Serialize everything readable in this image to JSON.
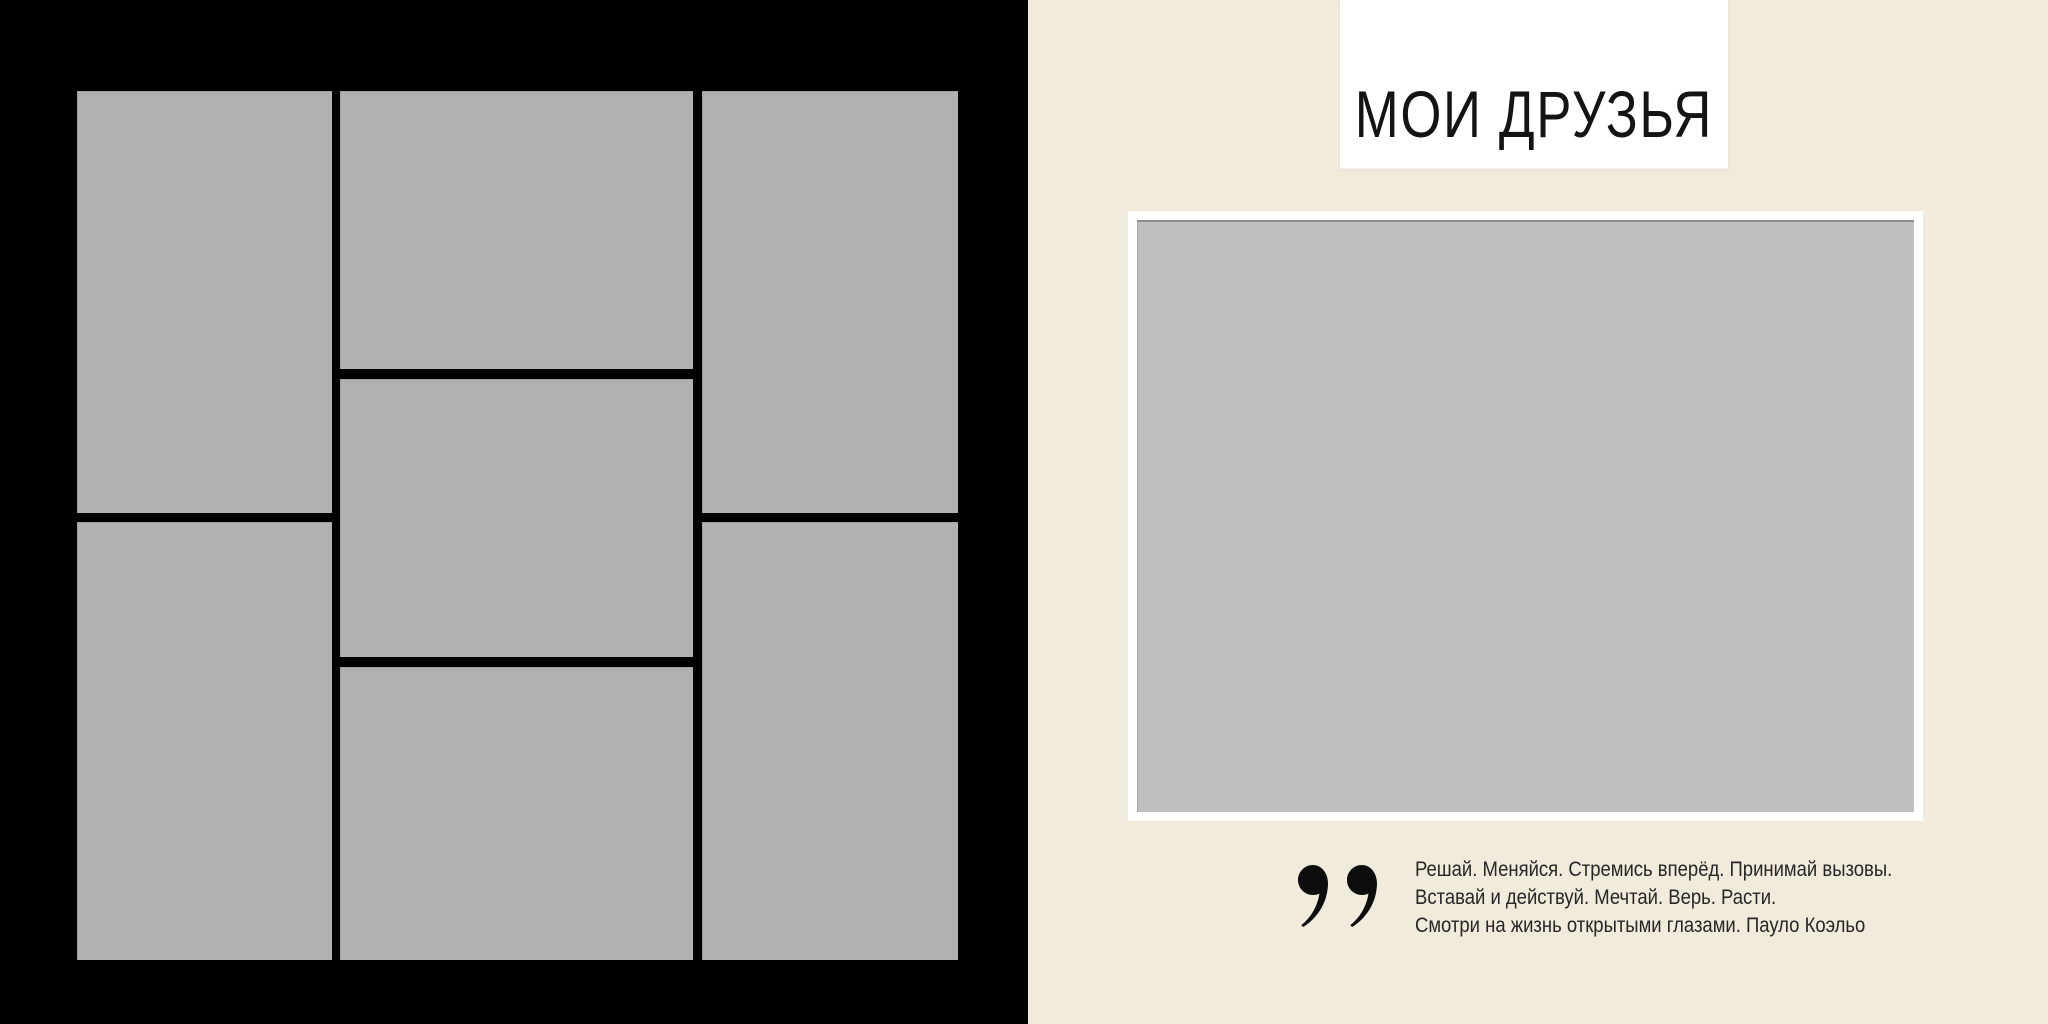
{
  "spread": {
    "left_page": {
      "background_color": "#000000",
      "placeholder_color": "#b1b1b1",
      "placeholder_count": 7
    },
    "right_page": {
      "background_color": "#f1ebdc",
      "title": "МОИ ДРУЗЬЯ",
      "title_plate_color": "#ffffff",
      "photo_frame_color": "#ffffff",
      "photo_placeholder_color": "#bfbfbf",
      "quote": {
        "mark_icon": "closing-double-quote-icon",
        "mark_color": "#0d0d0d",
        "line1": "Решай. Меняйся. Стремись вперёд. Принимай вызовы.",
        "line2": "Вставай и действуй. Мечтай. Верь. Расти.",
        "line3": "Смотри на жизнь открытыми глазами. Пауло Коэльо",
        "author": "Пауло Коэльо"
      }
    }
  }
}
